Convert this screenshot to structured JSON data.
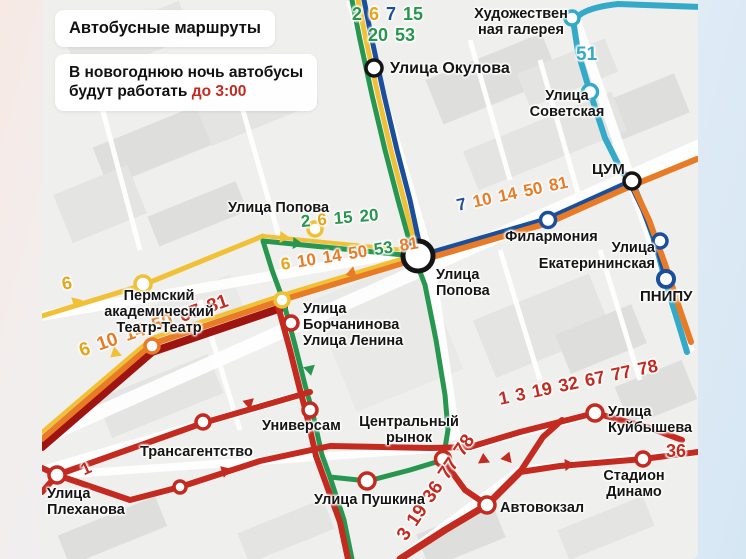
{
  "palette": {
    "green": "#27964e",
    "yellow": "#f0c137",
    "yellow_text": "#e5a519",
    "blue": "#1a4f9d",
    "teal": "#35a9c8",
    "orange": "#e87b26",
    "red": "#c32a20",
    "dark_red": "#9e1410",
    "black": "#141414",
    "map_bg": "#efefed"
  },
  "header": {
    "title": "Автобусные маршруты",
    "notice_line1": "В новогоднюю ночь автобусы",
    "notice_line2": "будут работать",
    "notice_highlight": "до 3:00",
    "highlight_color": "#c32a20"
  },
  "labels": {
    "okulova": "Улица Окулова",
    "gallery_line1": "Художествен",
    "gallery_line2": "ная галерея",
    "sovetskaya_line1": "Улица",
    "sovetskaya_line2": "Советская",
    "tsum": "ЦУМ",
    "filarmonia": "Филармония",
    "ekaterininskaya_line1": "Улица",
    "ekaterininskaya_line2": "Екатерининская",
    "pnipu": "ПНИПУ",
    "popova_west": "Улица Попова",
    "popova_junction_line1": "Улица",
    "popova_junction_line2": "Попова",
    "teatr_line1": "Пермский",
    "teatr_line2": "академический",
    "teatr_line3": "Театр-Театр",
    "borchaninova_line1": "Улица",
    "borchaninova_line2": "Борчанинова",
    "borchaninova_line3": "Улица Ленина",
    "universam": "Универсам",
    "rynok_line1": "Центральный",
    "rynok_line2": "рынок",
    "transagentstvo": "Трансагентство",
    "plekhanova_line1": "Улица",
    "plekhanova_line2": "Плеханова",
    "pushkina": "Улица Пушкина",
    "avtovokzal": "Автовокзал",
    "stadion_line1": "Стадион",
    "stadion_line2": "Динамо",
    "kuibysheva_line1": "Улица",
    "kuibysheva_line2": "Куйбышева"
  },
  "route_numbers": {
    "okulova_row1": [
      {
        "value": "2",
        "color": "#27964e"
      },
      {
        "value": "6",
        "color": "#e5a519"
      },
      {
        "value": "7",
        "color": "#1a4f9d"
      },
      {
        "value": "15",
        "color": "#27964e"
      }
    ],
    "okulova_row2": [
      {
        "value": "20",
        "color": "#27964e"
      },
      {
        "value": "53",
        "color": "#27964e"
      }
    ],
    "popova_upper": [
      {
        "value": "2",
        "color": "#27964e"
      },
      {
        "value": "6",
        "color": "#e5a519"
      },
      {
        "value": "15",
        "color": "#27964e"
      },
      {
        "value": "20",
        "color": "#27964e"
      }
    ],
    "popova_lower": [
      {
        "value": "6",
        "color": "#e5a519"
      },
      {
        "value": "10",
        "color": "#e87b26"
      },
      {
        "value": "14",
        "color": "#e87b26"
      },
      {
        "value": "50",
        "color": "#e87b26"
      },
      {
        "value": "53",
        "color": "#27964e"
      },
      {
        "value": "81",
        "color": "#e87b26"
      }
    ],
    "filarmonia_line": [
      {
        "value": "7",
        "color": "#1a4f9d"
      },
      {
        "value": "10",
        "color": "#e87b26"
      },
      {
        "value": "14",
        "color": "#e87b26"
      },
      {
        "value": "50",
        "color": "#e87b26"
      },
      {
        "value": "81",
        "color": "#e87b26"
      }
    ],
    "lenina_line": [
      {
        "value": "6",
        "color": "#e5a519"
      },
      {
        "value": "10",
        "color": "#e87b26"
      },
      {
        "value": "14",
        "color": "#e87b26"
      },
      {
        "value": "50",
        "color": "#e87b26"
      },
      {
        "value": "67",
        "color": "#c32a20"
      },
      {
        "value": "81",
        "color": "#c32a20"
      }
    ],
    "kuibysheva_line": [
      {
        "value": "1",
        "color": "#c32a20"
      },
      {
        "value": "3",
        "color": "#c32a20"
      },
      {
        "value": "19",
        "color": "#c32a20"
      },
      {
        "value": "32",
        "color": "#c32a20"
      },
      {
        "value": "67",
        "color": "#c32a20"
      },
      {
        "value": "77",
        "color": "#c32a20"
      },
      {
        "value": "78",
        "color": "#c32a20"
      }
    ],
    "avtovokzal_line": [
      {
        "value": "3",
        "color": "#c32a20"
      },
      {
        "value": "19",
        "color": "#c32a20"
      },
      {
        "value": "36",
        "color": "#c32a20"
      },
      {
        "value": "77",
        "color": "#c32a20"
      },
      {
        "value": "78",
        "color": "#c32a20"
      }
    ],
    "single_1": {
      "value": "1",
      "color": "#c32a20"
    },
    "single_6": {
      "value": "6",
      "color": "#e5a519"
    },
    "single_36": {
      "value": "36",
      "color": "#c32a20"
    },
    "single_51": {
      "value": "51",
      "color": "#35a9c8"
    }
  }
}
